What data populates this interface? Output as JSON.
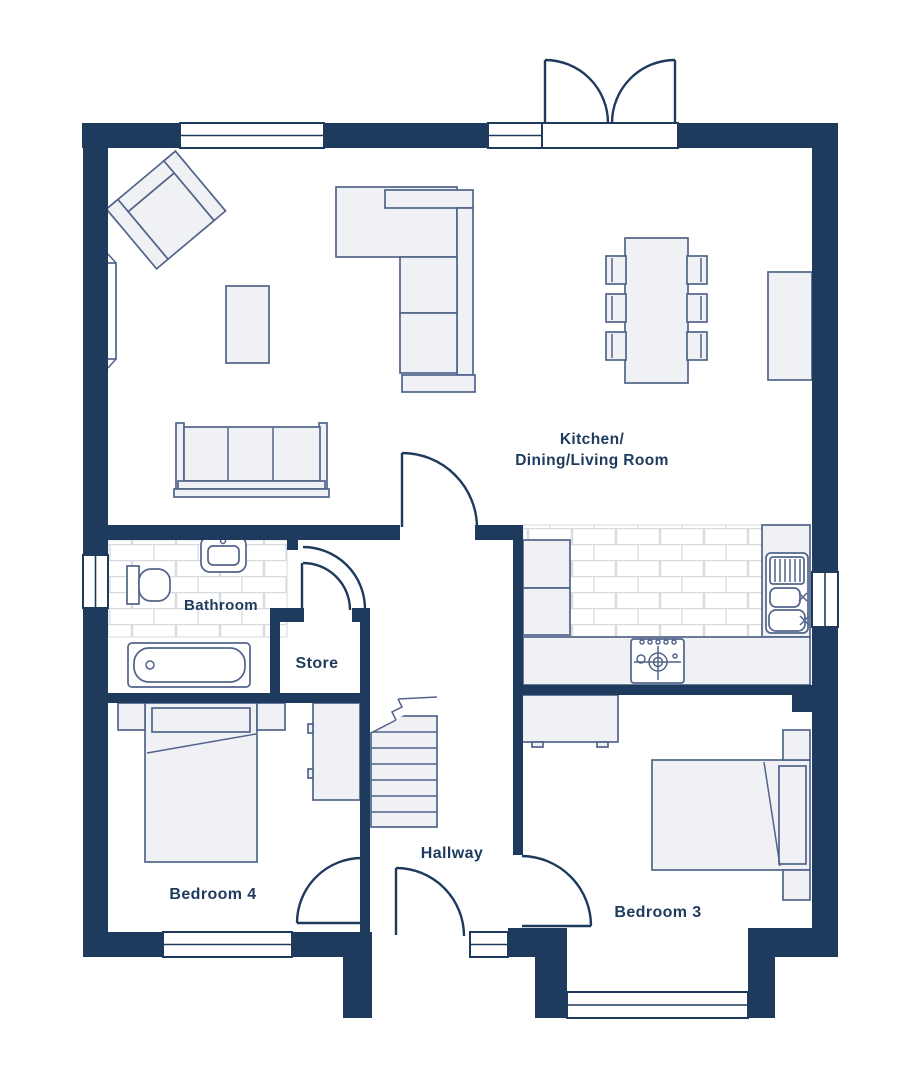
{
  "colors": {
    "wall": "#1e3a5c",
    "text": "#1e3a5c",
    "furniture_stroke": "#51648a",
    "furniture_fill": "#f0f1f4",
    "tile_line": "#d6dae1"
  },
  "rooms": {
    "kitchen": {
      "label_line1": "Kitchen/",
      "label_line2": "Dining/Living Room"
    },
    "bathroom": {
      "label": "Bathroom"
    },
    "store": {
      "label": "Store"
    },
    "hallway": {
      "label": "Hallway"
    },
    "bedroom4": {
      "label": "Bedroom 4"
    },
    "bedroom3": {
      "label": "Bedroom 3"
    }
  }
}
